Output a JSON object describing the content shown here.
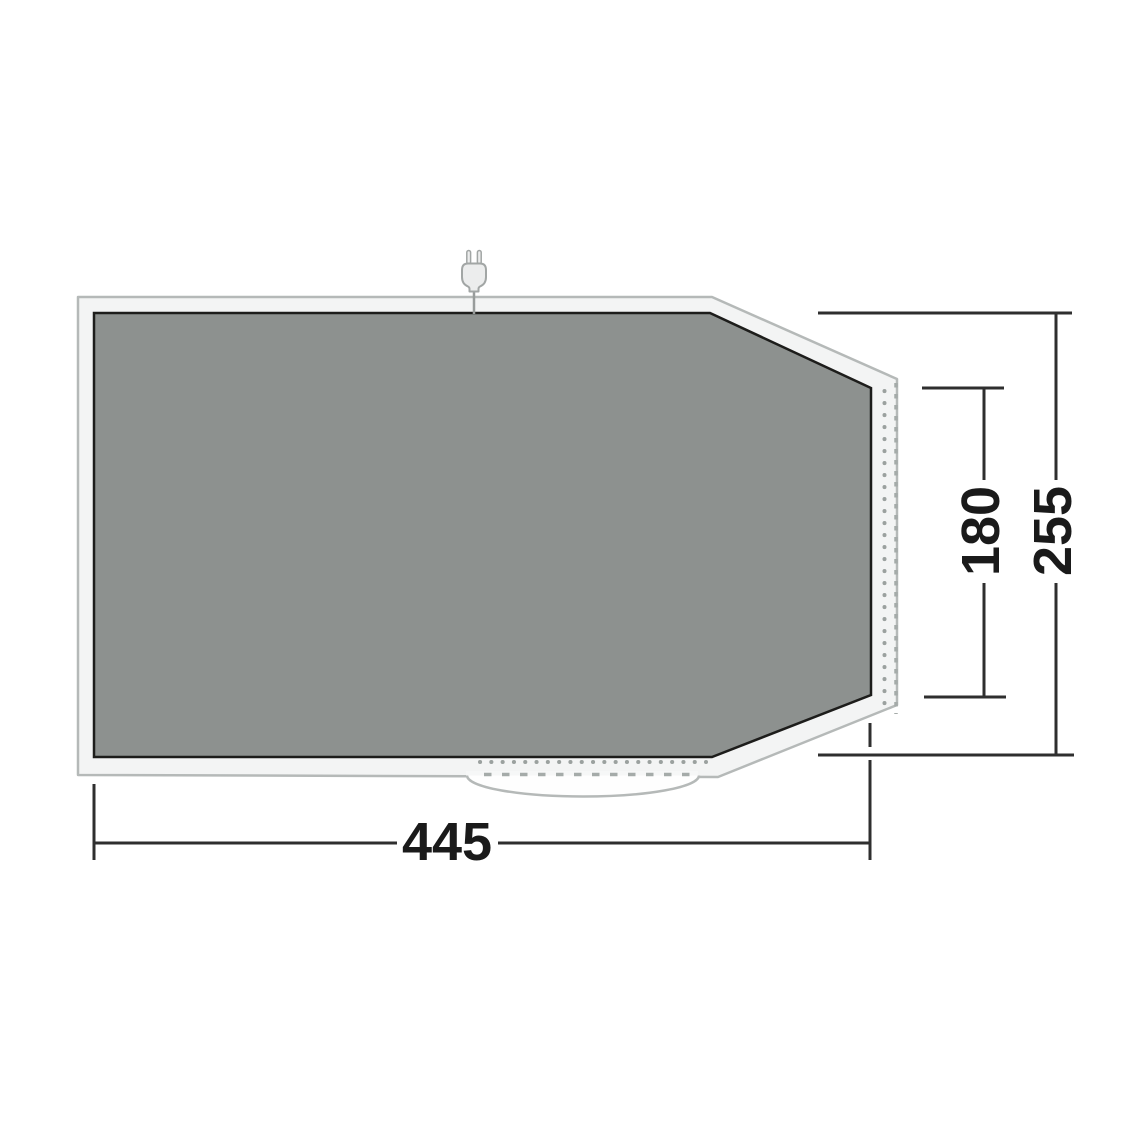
{
  "diagram": {
    "kind": "groundsheet-floorplan-with-dimensions",
    "dimension_labels": {
      "width": "445",
      "inner_height": "180",
      "total_height": "255"
    },
    "icons": [
      "power-plug-icon"
    ],
    "colors": {
      "groundsheet_fill": "#8d918f",
      "groundsheet_outline": "#1d1d1b",
      "band_fill": "#f3f4f4",
      "band_edge": "#b5b9b8",
      "stitching": "#9ba19f",
      "dimension_lines": "#2f2f2f",
      "label_text": "#1a1a1a"
    }
  }
}
